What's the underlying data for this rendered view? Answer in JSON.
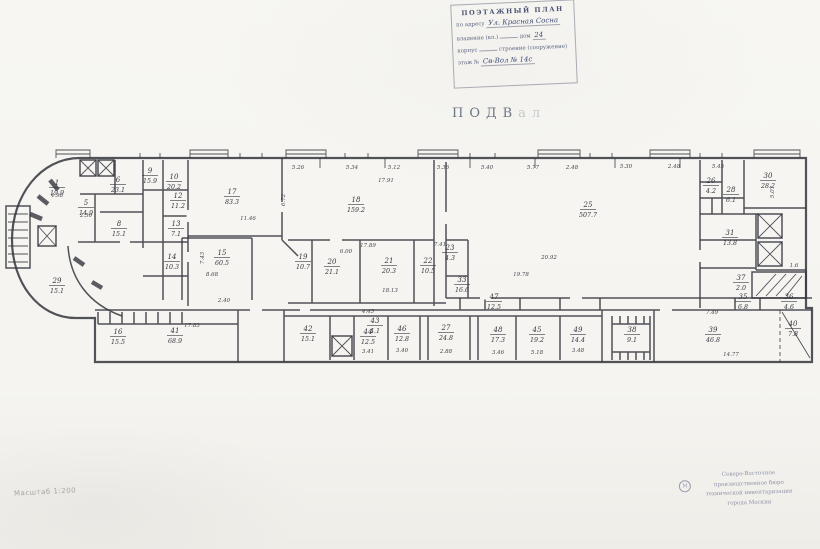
{
  "title": {
    "main": "ПОДВ",
    "tail": "ал"
  },
  "scale_note": "Масштаб 1:200",
  "top_stamp": {
    "line1": "ПОЭТАЖНЫЙ ПЛАН",
    "line2_label": "по адресу",
    "line2_value": "Ул. Красная Сосна",
    "line3_label": "владение (вл.)",
    "line3_mid": "дом",
    "line3_value": "24",
    "line4_a": "корпус",
    "line4_b": "строение (сооружение)",
    "line5_label": "этаж №",
    "line5_value": "Св-Вол № 14с"
  },
  "bottom_stamp": {
    "mark": "М",
    "lines": [
      "Северо-Восточное",
      "производственное бюро",
      "технической инвентаризации",
      "города Москвы"
    ]
  },
  "plan": {
    "rooms": [
      {
        "n": "1",
        "a": "19.9",
        "x": 57,
        "y": 185
      },
      {
        "n": "5",
        "a": "14.9",
        "x": 86,
        "y": 205
      },
      {
        "n": "6",
        "a": "23.1",
        "x": 118,
        "y": 182
      },
      {
        "n": "8",
        "a": "15.1",
        "x": 119,
        "y": 226
      },
      {
        "n": "29",
        "a": "15.1",
        "x": 57,
        "y": 283
      },
      {
        "n": "9",
        "a": "15.9",
        "x": 150,
        "y": 173
      },
      {
        "n": "10",
        "a": "20.2",
        "x": 174,
        "y": 179
      },
      {
        "n": "12",
        "a": "11.2",
        "x": 178,
        "y": 198
      },
      {
        "n": "13",
        "a": "7.1",
        "x": 176,
        "y": 226
      },
      {
        "n": "14",
        "a": "10.3",
        "x": 172,
        "y": 259
      },
      {
        "n": "17",
        "a": "83.3",
        "x": 232,
        "y": 194
      },
      {
        "n": "15",
        "a": "60.5",
        "x": 222,
        "y": 255
      },
      {
        "n": "18",
        "a": "159.2",
        "x": 356,
        "y": 202
      },
      {
        "n": "19",
        "a": "10.7",
        "x": 303,
        "y": 259
      },
      {
        "n": "20",
        "a": "21.1",
        "x": 332,
        "y": 264
      },
      {
        "n": "21",
        "a": "20.3",
        "x": 389,
        "y": 263
      },
      {
        "n": "22",
        "a": "10.5",
        "x": 428,
        "y": 263
      },
      {
        "n": "23",
        "a": "4.3",
        "x": 450,
        "y": 250
      },
      {
        "n": "33",
        "a": "16.6",
        "x": 462,
        "y": 282
      },
      {
        "n": "25",
        "a": "507.7",
        "x": 588,
        "y": 207
      },
      {
        "n": "26",
        "a": "4.2",
        "x": 711,
        "y": 183
      },
      {
        "n": "28",
        "a": "6.1",
        "x": 731,
        "y": 192
      },
      {
        "n": "30",
        "a": "28.2",
        "x": 768,
        "y": 178
      },
      {
        "n": "31",
        "a": "13.8",
        "x": 730,
        "y": 235
      },
      {
        "n": "37",
        "a": "2.0",
        "x": 741,
        "y": 280
      },
      {
        "n": "16",
        "a": "15.5",
        "x": 118,
        "y": 334
      },
      {
        "n": "41",
        "a": "68.9",
        "x": 175,
        "y": 333
      },
      {
        "n": "42",
        "a": "15.1",
        "x": 308,
        "y": 331
      },
      {
        "n": "43",
        "a": "4.1",
        "x": 375,
        "y": 323
      },
      {
        "n": "44",
        "a": "12.5",
        "x": 368,
        "y": 334
      },
      {
        "n": "46",
        "a": "12.8",
        "x": 402,
        "y": 331
      },
      {
        "n": "27",
        "a": "24.8",
        "x": 446,
        "y": 330
      },
      {
        "n": "47",
        "a": "12.5",
        "x": 494,
        "y": 299
      },
      {
        "n": "48",
        "a": "17.3",
        "x": 498,
        "y": 332
      },
      {
        "n": "45",
        "a": "19.2",
        "x": 537,
        "y": 332
      },
      {
        "n": "49",
        "a": "14.4",
        "x": 578,
        "y": 332
      },
      {
        "n": "35",
        "a": "6.8",
        "x": 743,
        "y": 299
      },
      {
        "n": "36",
        "a": "4.6",
        "x": 789,
        "y": 299
      },
      {
        "n": "38",
        "a": "9.1",
        "x": 632,
        "y": 332
      },
      {
        "n": "39",
        "a": "46.8",
        "x": 713,
        "y": 332
      },
      {
        "n": "40",
        "a": "7.8",
        "x": 793,
        "y": 326
      }
    ],
    "dims": [
      {
        "t": "5.26",
        "x": 298,
        "y": 169
      },
      {
        "t": "5.34",
        "x": 352,
        "y": 169
      },
      {
        "t": "5.12",
        "x": 394,
        "y": 169
      },
      {
        "t": "5.36",
        "x": 443,
        "y": 169
      },
      {
        "t": "5.40",
        "x": 487,
        "y": 169
      },
      {
        "t": "5.77",
        "x": 533,
        "y": 169
      },
      {
        "t": "2.48",
        "x": 572,
        "y": 169
      },
      {
        "t": "5.30",
        "x": 626,
        "y": 168
      },
      {
        "t": "2.48",
        "x": 674,
        "y": 168
      },
      {
        "t": "5.45",
        "x": 718,
        "y": 168
      },
      {
        "t": "17.91",
        "x": 386,
        "y": 182
      },
      {
        "t": "11.46",
        "x": 248,
        "y": 220
      },
      {
        "t": "17.89",
        "x": 368,
        "y": 247
      },
      {
        "t": "6.72",
        "x": 285,
        "y": 200,
        "r": -90
      },
      {
        "t": "7.43",
        "x": 204,
        "y": 258,
        "r": -90
      },
      {
        "t": "20.92",
        "x": 549,
        "y": 259
      },
      {
        "t": "19.78",
        "x": 521,
        "y": 276
      },
      {
        "t": "8.68",
        "x": 212,
        "y": 276
      },
      {
        "t": "2.40",
        "x": 224,
        "y": 302
      },
      {
        "t": "6.00",
        "x": 346,
        "y": 253
      },
      {
        "t": "18.13",
        "x": 390,
        "y": 292
      },
      {
        "t": "7.41",
        "x": 440,
        "y": 246
      },
      {
        "t": "4.45",
        "x": 368,
        "y": 313
      },
      {
        "t": "17.83",
        "x": 192,
        "y": 327
      },
      {
        "t": "3.41",
        "x": 368,
        "y": 353
      },
      {
        "t": "3.40",
        "x": 402,
        "y": 352
      },
      {
        "t": "2.88",
        "x": 446,
        "y": 353
      },
      {
        "t": "3.46",
        "x": 498,
        "y": 354
      },
      {
        "t": "5.18",
        "x": 537,
        "y": 354
      },
      {
        "t": "3.48",
        "x": 578,
        "y": 352
      },
      {
        "t": "7.49",
        "x": 712,
        "y": 314
      },
      {
        "t": "14.77",
        "x": 731,
        "y": 356
      },
      {
        "t": "5.07",
        "x": 774,
        "y": 192,
        "r": -90
      },
      {
        "t": "1.6",
        "x": 794,
        "y": 267
      },
      {
        "t": "4.98",
        "x": 57,
        "y": 197
      },
      {
        "t": "2.50",
        "x": 86,
        "y": 217
      }
    ]
  }
}
